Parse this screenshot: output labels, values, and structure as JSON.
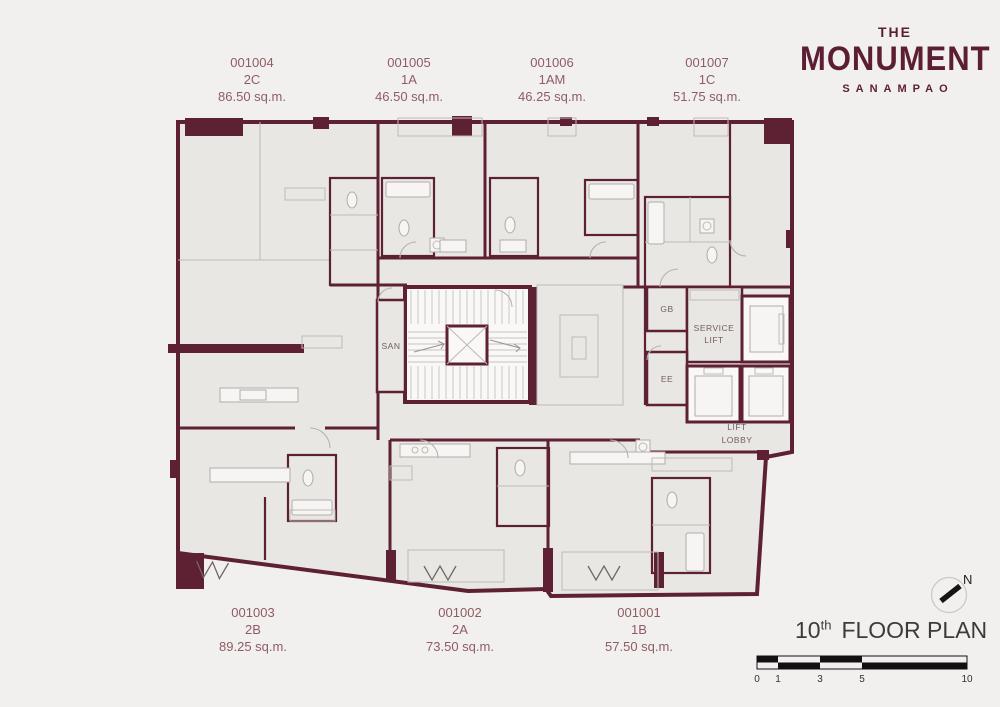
{
  "logo": {
    "line1": "THE",
    "line2": "MONUMENT",
    "line3": "SANAMPAO"
  },
  "units_top": [
    {
      "id": "001004",
      "type": "2C",
      "area": "86.50 sq.m."
    },
    {
      "id": "001005",
      "type": "1A",
      "area": "46.50 sq.m."
    },
    {
      "id": "001006",
      "type": "1AM",
      "area": "46.25 sq.m."
    },
    {
      "id": "001007",
      "type": "1C",
      "area": "51.75 sq.m."
    }
  ],
  "units_bottom": [
    {
      "id": "001003",
      "type": "2B",
      "area": "89.25 sq.m."
    },
    {
      "id": "001002",
      "type": "2A",
      "area": "73.50 sq.m."
    },
    {
      "id": "001001",
      "type": "1B",
      "area": "57.50 sq.m."
    }
  ],
  "plan_labels": {
    "san": "SAN",
    "gb": "GB",
    "service_lift": [
      "SERVICE",
      "LIFT"
    ],
    "ee": "EE",
    "lift_lobby": [
      "LIFT",
      "LOBBY"
    ]
  },
  "title": {
    "floor": "10",
    "ordinal": "th",
    "label": "FLOOR PLAN"
  },
  "north_label": "N",
  "scale_ticks": [
    "0",
    "1",
    "3",
    "5",
    "10"
  ],
  "colors": {
    "wall": "#5e2133",
    "room": "#e9e7e4",
    "background": "#f2f0ee",
    "unit_label": "#8e5c63",
    "logo": "#5c1e32",
    "plan_text": "#6f5d61"
  }
}
